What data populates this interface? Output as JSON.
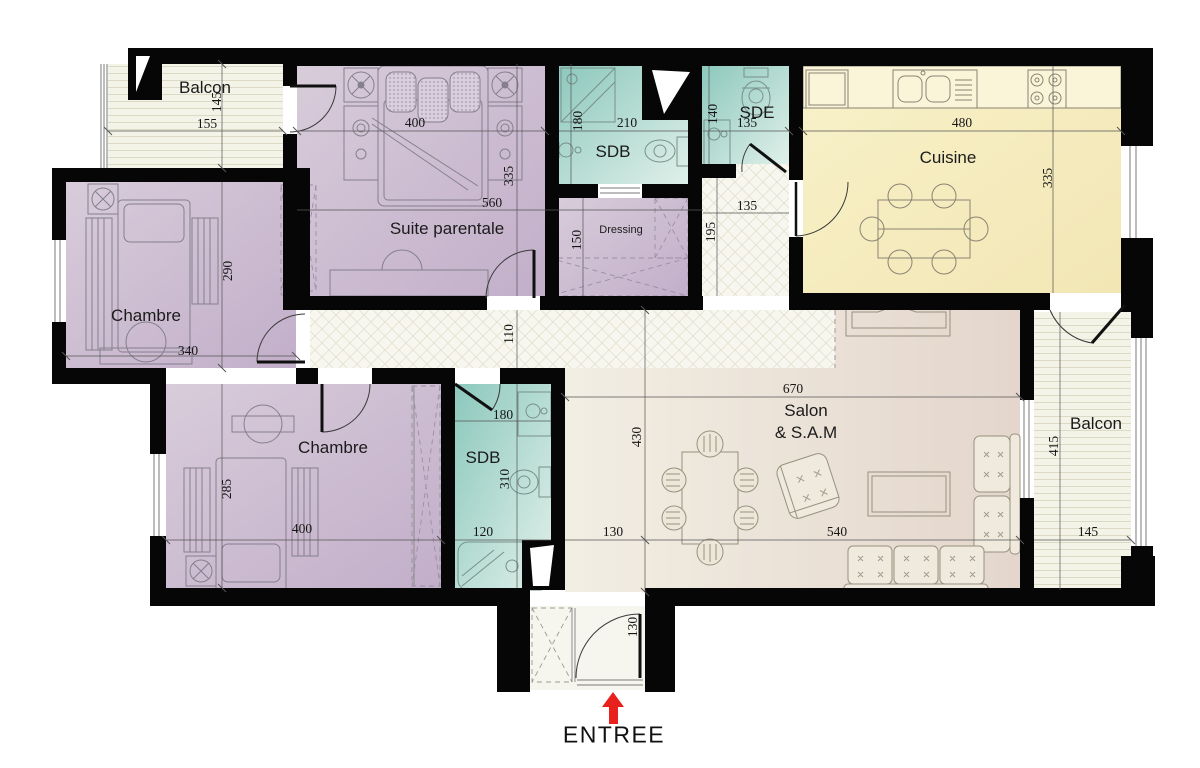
{
  "plan": {
    "rooms": {
      "balcon_tl": {
        "label": "Balcon"
      },
      "suite_parentale": {
        "label": "Suite parentale"
      },
      "sdb_top": {
        "label": "SDB"
      },
      "sde": {
        "label": "SDE"
      },
      "cuisine": {
        "label": "Cuisine"
      },
      "dressing": {
        "label": "Dressing"
      },
      "chambre_left": {
        "label": "Chambre"
      },
      "chambre_bottom": {
        "label": "Chambre"
      },
      "sdb_bottom": {
        "label": "SDB"
      },
      "salon": {
        "label_line1": "Salon",
        "label_line2": "& S.A.M"
      },
      "balcon_right": {
        "label": "Balcon"
      }
    },
    "entrance": {
      "label": "ENTREE"
    },
    "dims": {
      "balcon_tl_w": "155",
      "balcon_tl_h": "145",
      "suite_bed_w": "400",
      "suite_h": "335",
      "suite_w": "560",
      "sdb_top_h": "180",
      "sdb_top_w": "210",
      "sde_h": "140",
      "sde_w": "135",
      "cuisine_w": "480",
      "cuisine_h": "335",
      "dressing_h": "150",
      "hall_w": "135",
      "hall_h": "195",
      "corridor_h": "110",
      "chambre_left_h": "290",
      "chambre_left_w": "340",
      "chambre_bottom_h": "285",
      "chambre_bottom_w": "400",
      "sdb_bottom_top_w": "180",
      "sdb_bottom_h": "310",
      "sdb_bottom_bottom_w": "120",
      "salon_w": "670",
      "salon_h": "430",
      "salon_offset": "130",
      "salon_bottom_w": "540",
      "balcon_right_h": "415",
      "balcon_right_w": "145",
      "entrance_door_w": "130"
    },
    "colors": {
      "bedroom": "#cdc0d2",
      "bathroom": "#9acfc3",
      "kitchen": "#f6eec3",
      "living": "#ebe3d6",
      "wall": "#000000",
      "arrow": "#e8211d"
    }
  }
}
